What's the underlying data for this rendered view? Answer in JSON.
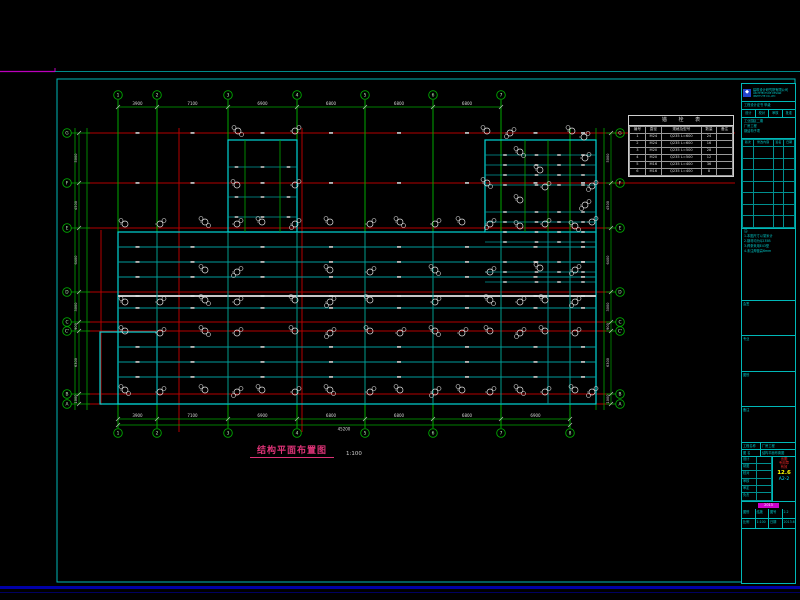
{
  "colors": {
    "bg": "#000000",
    "frame": "#00b8b8",
    "magenta": "#bb00bb",
    "navy": "#0000a8",
    "red": "#b40000",
    "green": "#00a800",
    "teal": "#009c9c",
    "cyan": "#00d4d4",
    "gray": "#c8c8c8",
    "white": "#e0e0e0",
    "dim_text": "#d8d8d8",
    "title_magenta": "#dd3377"
  },
  "title": {
    "text": "结构平面布置图",
    "scale": "1:100"
  },
  "plan": {
    "v_axes": [
      {
        "label": "1",
        "x": 118
      },
      {
        "label": "2",
        "x": 157
      },
      {
        "label": "3",
        "x": 228
      },
      {
        "label": "4",
        "x": 297
      },
      {
        "label": "5",
        "x": 365
      },
      {
        "label": "6",
        "x": 433
      },
      {
        "label": "7",
        "x": 501
      },
      {
        "label": "8",
        "x": 570,
        "top": false
      }
    ],
    "h_axes": [
      {
        "label": "G",
        "y": 133
      },
      {
        "label": "F",
        "y": 183
      },
      {
        "label": "E",
        "y": 228
      },
      {
        "label": "D",
        "y": 292
      },
      {
        "label": "C",
        "y": 322
      },
      {
        "label": "C'",
        "y": 331
      },
      {
        "label": "B",
        "y": 394
      },
      {
        "label": "A",
        "y": 404
      }
    ],
    "dims": {
      "top": [
        "3900",
        "7100",
        "6900",
        "6800",
        "6800",
        "6800"
      ],
      "bottom": [
        "3900",
        "7100",
        "6900",
        "6800",
        "6800",
        "6800",
        "6900"
      ],
      "bottom_total": "45200",
      "side": [
        "5000",
        "4500",
        "6400",
        "3000",
        "900",
        "6300",
        "1000"
      ]
    },
    "outlines": {
      "main": [
        118,
        232,
        596,
        404
      ],
      "stair": [
        228,
        140,
        297,
        232
      ],
      "wing": [
        485,
        140,
        596,
        232
      ],
      "annex": [
        100,
        332,
        157,
        404
      ]
    },
    "beams": {
      "main_h_y": [
        247,
        262,
        277,
        308,
        347,
        362,
        377
      ],
      "gray_y": 296,
      "wing_h_y": [
        155,
        165,
        175,
        185,
        212,
        222,
        232,
        242,
        262,
        272,
        282
      ],
      "stair_h_y": [
        167,
        197,
        217
      ],
      "main_v_x": [
        157,
        228,
        297,
        365,
        433,
        501,
        548,
        570
      ],
      "wing_v_x": [
        525,
        548
      ],
      "stair_v_x": [
        245,
        280
      ]
    },
    "callouts": [
      [
        238,
        131
      ],
      [
        295,
        131
      ],
      [
        487,
        131
      ],
      [
        510,
        133
      ],
      [
        572,
        131
      ],
      [
        584,
        137
      ],
      [
        520,
        152
      ],
      [
        585,
        158
      ],
      [
        540,
        170
      ],
      [
        592,
        186
      ],
      [
        237,
        185
      ],
      [
        295,
        185
      ],
      [
        487,
        183
      ],
      [
        545,
        187
      ],
      [
        520,
        200
      ],
      [
        585,
        205
      ],
      [
        125,
        224
      ],
      [
        160,
        224
      ],
      [
        205,
        222
      ],
      [
        237,
        224
      ],
      [
        262,
        222
      ],
      [
        295,
        224
      ],
      [
        330,
        222
      ],
      [
        370,
        224
      ],
      [
        400,
        222
      ],
      [
        435,
        224
      ],
      [
        462,
        222
      ],
      [
        490,
        224
      ],
      [
        520,
        226
      ],
      [
        545,
        224
      ],
      [
        575,
        226
      ],
      [
        592,
        222
      ],
      [
        205,
        270
      ],
      [
        237,
        272
      ],
      [
        330,
        270
      ],
      [
        370,
        272
      ],
      [
        435,
        270
      ],
      [
        490,
        272
      ],
      [
        540,
        268
      ],
      [
        575,
        270
      ],
      [
        125,
        302
      ],
      [
        160,
        302
      ],
      [
        205,
        300
      ],
      [
        237,
        302
      ],
      [
        295,
        300
      ],
      [
        330,
        302
      ],
      [
        370,
        300
      ],
      [
        435,
        302
      ],
      [
        490,
        300
      ],
      [
        520,
        302
      ],
      [
        545,
        300
      ],
      [
        575,
        302
      ],
      [
        125,
        331
      ],
      [
        160,
        333
      ],
      [
        205,
        331
      ],
      [
        237,
        333
      ],
      [
        295,
        331
      ],
      [
        330,
        333
      ],
      [
        370,
        331
      ],
      [
        400,
        333
      ],
      [
        435,
        331
      ],
      [
        462,
        333
      ],
      [
        490,
        331
      ],
      [
        520,
        333
      ],
      [
        545,
        331
      ],
      [
        575,
        333
      ],
      [
        125,
        390
      ],
      [
        160,
        392
      ],
      [
        205,
        390
      ],
      [
        237,
        392
      ],
      [
        262,
        390
      ],
      [
        295,
        392
      ],
      [
        330,
        390
      ],
      [
        370,
        392
      ],
      [
        400,
        390
      ],
      [
        435,
        392
      ],
      [
        462,
        390
      ],
      [
        490,
        392
      ],
      [
        520,
        390
      ],
      [
        545,
        392
      ],
      [
        575,
        390
      ],
      [
        592,
        392
      ]
    ]
  },
  "schedule": {
    "title": "锚 栓 表",
    "headers": [
      "编号",
      "直径",
      "规格及型号",
      "数量",
      "备注"
    ],
    "rows": [
      [
        "1",
        "M24",
        "Q235 L=600",
        "24",
        ""
      ],
      [
        "2",
        "M24",
        "Q235 L=600",
        "16",
        ""
      ],
      [
        "3",
        "M20",
        "Q235 L=500",
        "28",
        ""
      ],
      [
        "4",
        "M20",
        "Q235 L=500",
        "12",
        ""
      ],
      [
        "5",
        "M16",
        "Q235 L=400",
        "36",
        ""
      ],
      [
        "6",
        "M16",
        "Q235 L=400",
        "8",
        ""
      ]
    ]
  },
  "titleblock": {
    "company": "建筑设计研究院有限公司",
    "company_en": "ARCHITECTURE DESIGN INSTITUTE CO.,LTD",
    "cert": "工程设计证书 甲级",
    "mini_headers": [
      "设计",
      "校对",
      "审核",
      "批准"
    ],
    "project_lines": [
      "工业园区二期",
      "厂房工程",
      "钢结构子项"
    ],
    "rev_headers": [
      "版次",
      "修改内容",
      "签名",
      "日期"
    ],
    "rev_rows": [
      [
        "",
        "",
        "",
        ""
      ],
      [
        "",
        "",
        "",
        ""
      ],
      [
        "",
        "",
        "",
        ""
      ],
      [
        "",
        "",
        "",
        ""
      ],
      [
        "",
        "",
        "",
        ""
      ],
      [
        "",
        "",
        "",
        ""
      ],
      [
        "",
        "",
        "",
        ""
      ]
    ],
    "notes": [
      "注:",
      "1.本图尺寸以毫米计",
      "2.钢材均为Q235B",
      "3.焊条采用E43型",
      "4.未注焊缝高6mm"
    ],
    "boxes": [
      "会签",
      "专业",
      "图别",
      "备注"
    ],
    "fields": {
      "project_label": "工程名称",
      "project": "厂房工程",
      "drawing_label": "图  名",
      "drawing": "结构平面布置图"
    },
    "persons": [
      [
        "设计",
        ""
      ],
      [
        "制图",
        ""
      ],
      [
        "校对",
        ""
      ],
      [
        "审核",
        ""
      ],
      [
        "审定",
        ""
      ],
      [
        "负责",
        ""
      ]
    ],
    "stamp_red": [
      "出图",
      "专用章",
      "有效"
    ],
    "date_yellow": "12.6",
    "sheet_cyan": "A2-2",
    "badge_magenta": "2013",
    "bottom_rows": [
      [
        "图别",
        "结施",
        "图号",
        "2.2"
      ],
      [
        "比例",
        "1:100",
        "日期",
        "2013.6"
      ]
    ]
  }
}
